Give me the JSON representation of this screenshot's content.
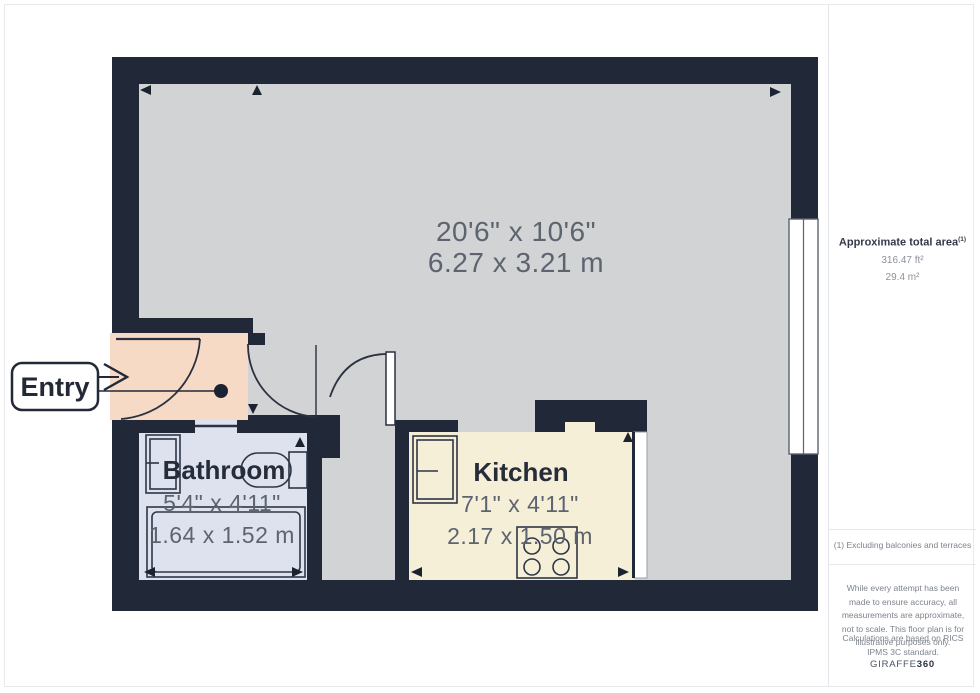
{
  "floorplan": {
    "entry": {
      "label": "Entry"
    },
    "main_room": {
      "imperial": "20'6\" x 10'6\"",
      "metric": "6.27 x 3.21 m"
    },
    "bathroom": {
      "name": "Bathroom",
      "imperial": "5'4\" x 4'11\"",
      "metric": "1.64 x 1.52 m"
    },
    "kitchen": {
      "name": "Kitchen",
      "imperial": "7'1\" x 4'11\"",
      "metric": "2.17 x 1.50 m"
    },
    "colors": {
      "wall": "#212837",
      "floor": "#d2d3d4",
      "entry_floor": "#f7dac6",
      "bathroom_floor": "#dee2ef",
      "kitchen_floor": "#f6efd7",
      "name_text": "#262c39",
      "dim_text": "#5d6470"
    }
  },
  "sidebar": {
    "area_title": "Approximate total area",
    "area_sup": "(1)",
    "area_ft": "316.47 ft²",
    "area_m": "29.4 m²",
    "footnote": "(1) Excluding balconies and terraces",
    "disclaimer": "While every attempt has been made to ensure accuracy, all measurements are approximate, not to scale. This floor plan is for illustrative purposes only.",
    "standard": "Calculations are based on RICS IPMS 3C standard.",
    "brand_name": "GIRAFFE",
    "brand_suffix": "360"
  }
}
